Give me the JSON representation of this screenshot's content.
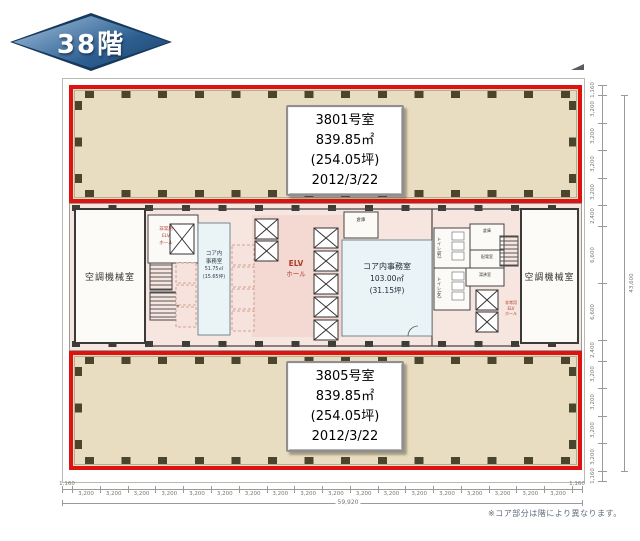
{
  "floor_badge": {
    "label": "38階"
  },
  "units": [
    {
      "name": "3801号室",
      "area_m2": "839.85㎡",
      "area_tsubo": "(254.05坪)",
      "date": "2012/3/22"
    },
    {
      "name": "3805号室",
      "area_m2": "839.85㎡",
      "area_tsubo": "(254.05坪)",
      "date": "2012/3/22"
    }
  ],
  "core": {
    "machine_room_left": "空調機械室",
    "machine_room_right": "空調機械室",
    "emergency_elv_left": [
      "非常用",
      "ELV",
      "ホール"
    ],
    "emergency_elv_right": [
      "非常用",
      "ELV",
      "ホール"
    ],
    "office_left": {
      "name_l1": "コア内",
      "name_l2": "事務室",
      "area": "51.75㎡",
      "tsubo": "(15.65坪)"
    },
    "elv_hall": [
      "ELV",
      "ホール"
    ],
    "storage_center": "倉庫",
    "office_center": {
      "name": "コア内事務室",
      "area": "103.00㎡",
      "tsubo": "(31.15坪)"
    },
    "toilet_men": "トイレ(男)",
    "toilet_women": "トイレ(女)",
    "storage_right": "倉庫",
    "electrical_room": "配電室",
    "hot_water_room": "湯沸室"
  },
  "dimensions": {
    "bottom": {
      "edge_left": "1,160",
      "segment": "3,200",
      "segment_count": 18,
      "edge_right": "1,160",
      "total": "59,920"
    },
    "right": {
      "values": [
        "1,160",
        "3,200",
        "3,200",
        "3,200",
        "3,200",
        "2,400",
        "6,600",
        "6,600",
        "2,400",
        "3,200",
        "3,200",
        "3,200",
        "3,200",
        "1,160"
      ],
      "total": "43,600"
    }
  },
  "note": "※コア部分は階により異なります。",
  "colors": {
    "unit_border_red": "#de1310",
    "unit_fill": "#e9ddc1",
    "core_fill": "#f7e6df",
    "badge_blue": "#2e5f92",
    "office_fill": "#eaf3f5",
    "elv_hall_text": "#b03a2e"
  }
}
